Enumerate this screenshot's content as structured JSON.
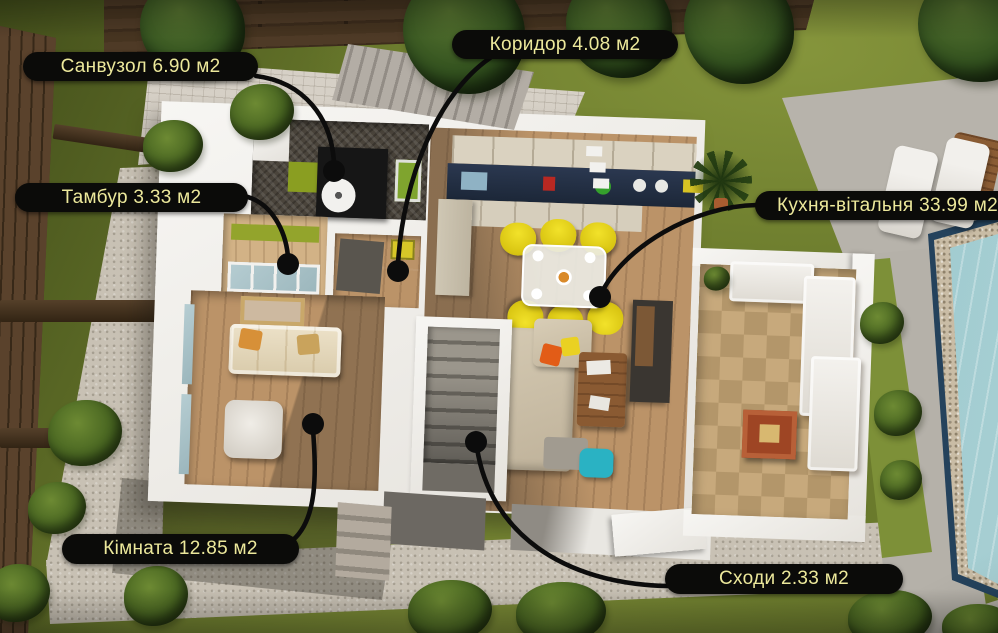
{
  "image_type": "3d-floor-plan-aerial-render",
  "language": "uk",
  "rooms": [
    {
      "id": "sanvuzol",
      "name": "Санвузол",
      "area": "6.90",
      "unit": "м2",
      "label": "Санвузол 6.90 м2"
    },
    {
      "id": "korydor",
      "name": "Коридор",
      "area": "4.08",
      "unit": "м2",
      "label": "Коридор 4.08 м2"
    },
    {
      "id": "tambur",
      "name": "Тамбур",
      "area": "3.33",
      "unit": "м2",
      "label": "Тамбур 3.33 м2"
    },
    {
      "id": "kukhnia-vitalnia",
      "name": "Кухня-вітальня",
      "area": "33.99",
      "unit": "м2",
      "label": "Кухня-вітальня 33.99 м2"
    },
    {
      "id": "kimnata",
      "name": "Кімната",
      "area": "12.85",
      "unit": "м2",
      "label": "Кімната 12.85 м2"
    },
    {
      "id": "skhody",
      "name": "Сходи",
      "area": "2.33",
      "unit": "м2",
      "label": "Сходи 2.33 м2"
    }
  ],
  "style": {
    "label_background": "#0b0b09",
    "label_text_color": "#ece89b",
    "leader_line_color": "#0c0c0c",
    "lawn_green": "#6a7a2c",
    "house_wall_white": "#f2f0ec",
    "wood_floor": "#bb9368",
    "pool_water": "#9cc6cb",
    "dining_chair_yellow": "#e8d418",
    "patio_stone_tan": "#c3a274"
  }
}
